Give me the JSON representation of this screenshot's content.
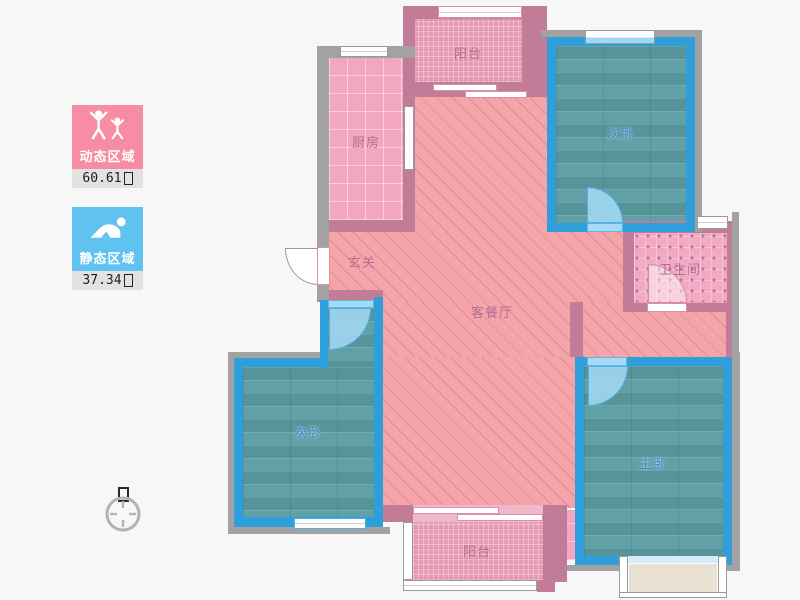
{
  "legend": {
    "dynamic_card": {
      "label": "动态区域",
      "value": "60.61",
      "unit_icon": "missing-glyph-box",
      "color": "#f78da4"
    },
    "static_card": {
      "label": "静态区域",
      "value": "37.34",
      "unit_icon": "missing-glyph-box",
      "color": "#5fc2f1"
    }
  },
  "compass": {
    "north_icon": "north-glyph-box"
  },
  "rooms": {
    "balcony_top": {
      "label": "阳台"
    },
    "kitchen": {
      "label": "厨房"
    },
    "bedroom_top_right": {
      "label": "次卧"
    },
    "bathroom": {
      "label": "卫生间"
    },
    "foyer": {
      "label": "玄关"
    },
    "living_dining": {
      "label": "客餐厅"
    },
    "bedroom_bottom_left": {
      "label": "次卧"
    },
    "master_bedroom": {
      "label": "主卧"
    },
    "balcony_bottom": {
      "label": "阳台"
    }
  },
  "colors": {
    "wall_pink": "#c17c97",
    "wall_blue": "#2f9fdb",
    "wall_gray": "#a2a2a2",
    "floor_living": "#f5a4aa",
    "floor_kitchen": "#f2a6c0",
    "floor_balcony": "#e79cb3",
    "floor_bathroom": "#f2a9c4",
    "floor_bedroom": "#60a1a7",
    "door_arc_blue": "#a6d9f3",
    "bay_window_fill": "#e9e1d1",
    "legend_dynamic": "#f78da4",
    "legend_static": "#5fc2f1",
    "value_strip": "#e2e2e2",
    "label_pink": "#b46f92",
    "label_blue": "#3f87c9",
    "background": "#f7f7f7"
  }
}
